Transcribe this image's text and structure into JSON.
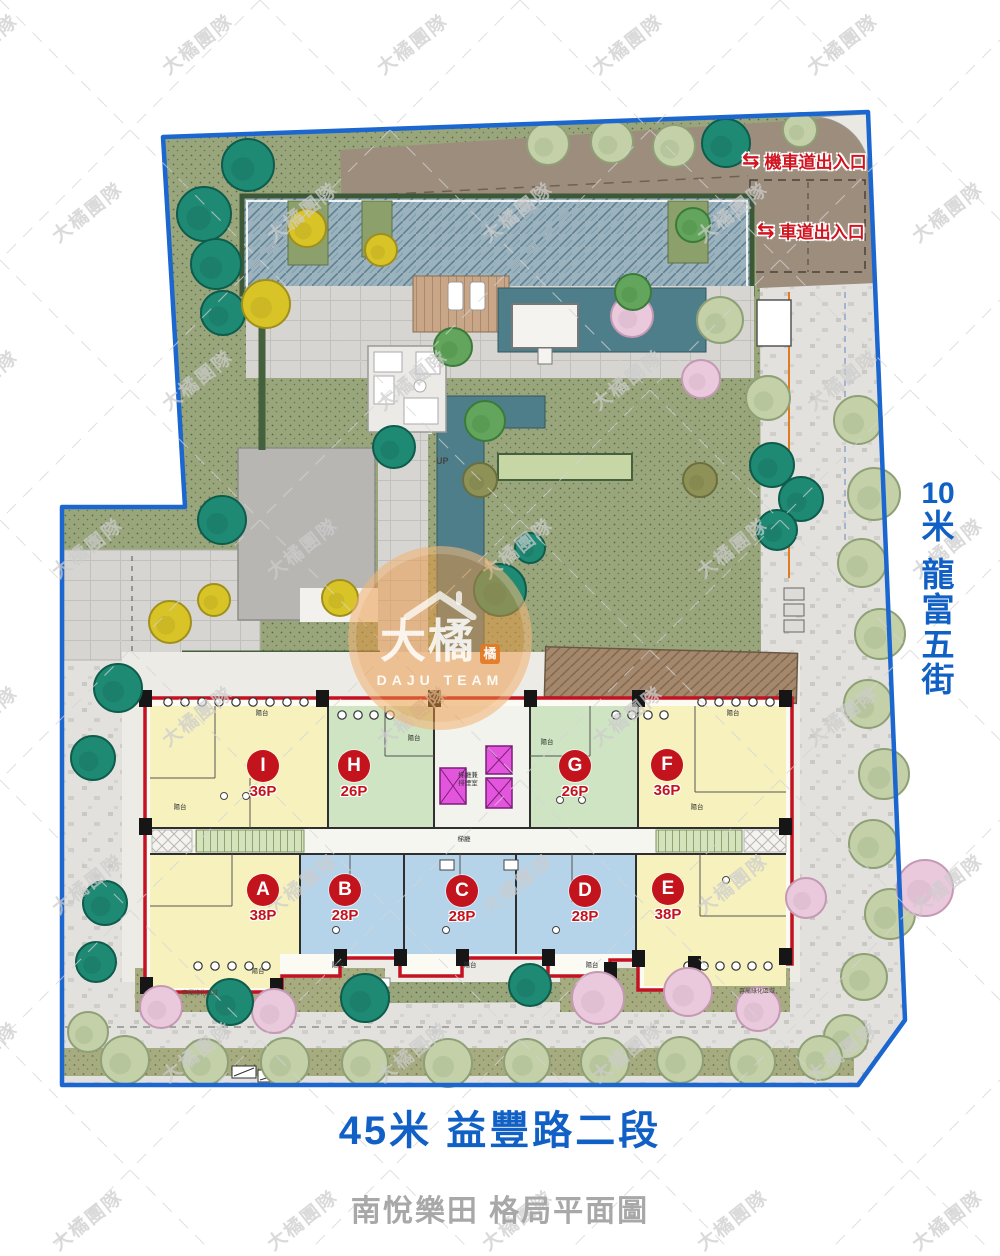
{
  "caption": {
    "project_title": "南悅樂田 格局平面圖"
  },
  "streets": {
    "right": {
      "full": "10米 龍富五街",
      "lines": [
        "10",
        "米",
        "龍",
        "富",
        "五",
        "街"
      ]
    },
    "bottom": {
      "label": "45米 益豐路二段"
    }
  },
  "entrances": {
    "moto": {
      "label": "機車道出入口",
      "icon": "⇆"
    },
    "car": {
      "label": "車道出入口",
      "icon": "⇆"
    }
  },
  "watermark": {
    "team_text": "大橘團隊",
    "logo_main": "大橘",
    "logo_badge": "橘",
    "logo_sub": "DAJU TEAM"
  },
  "building": {
    "units": [
      {
        "id": "I",
        "size": "36P",
        "color": "yellow",
        "cx": 263,
        "cy": 767
      },
      {
        "id": "H",
        "size": "26P",
        "color": "green",
        "cx": 354,
        "cy": 767
      },
      {
        "id": "G",
        "size": "26P",
        "color": "green",
        "cx": 575,
        "cy": 767
      },
      {
        "id": "F",
        "size": "36P",
        "color": "yellow",
        "cx": 667,
        "cy": 766
      },
      {
        "id": "A",
        "size": "38P",
        "color": "yellow",
        "cx": 263,
        "cy": 891
      },
      {
        "id": "B",
        "size": "28P",
        "color": "blue",
        "cx": 345,
        "cy": 891
      },
      {
        "id": "C",
        "size": "28P",
        "color": "blue",
        "cx": 462,
        "cy": 892
      },
      {
        "id": "D",
        "size": "28P",
        "color": "blue",
        "cx": 585,
        "cy": 892
      },
      {
        "id": "E",
        "size": "38P",
        "color": "yellow",
        "cx": 668,
        "cy": 890
      }
    ],
    "labels": {
      "core_line1": "梯廳兼",
      "core_line2": "排煙室",
      "lobby": "梯廳",
      "balcony": "陽台",
      "patio": "專屬綠化區域",
      "up": "UP"
    },
    "balcony_positions": [
      [
        262,
        712
      ],
      [
        180,
        806
      ],
      [
        414,
        737
      ],
      [
        547,
        741
      ],
      [
        733,
        712
      ],
      [
        697,
        806
      ],
      [
        338,
        964
      ],
      [
        470,
        964
      ],
      [
        592,
        964
      ],
      [
        258,
        970
      ]
    ],
    "window_rows": [
      {
        "x": 168,
        "y": 702,
        "n": 9,
        "s": 17
      },
      {
        "x": 342,
        "y": 715,
        "n": 4,
        "s": 16
      },
      {
        "x": 616,
        "y": 715,
        "n": 4,
        "s": 16
      },
      {
        "x": 702,
        "y": 702,
        "n": 5,
        "s": 17
      },
      {
        "x": 198,
        "y": 966,
        "n": 5,
        "s": 17
      },
      {
        "x": 688,
        "y": 966,
        "n": 6,
        "s": 16
      }
    ],
    "pillars": [
      [
        139,
        690
      ],
      [
        316,
        690
      ],
      [
        428,
        690
      ],
      [
        524,
        690
      ],
      [
        632,
        690
      ],
      [
        779,
        690
      ],
      [
        139,
        818
      ],
      [
        779,
        818
      ],
      [
        140,
        977
      ],
      [
        270,
        978
      ],
      [
        334,
        949
      ],
      [
        394,
        949
      ],
      [
        456,
        949
      ],
      [
        542,
        949
      ],
      [
        604,
        962
      ],
      [
        632,
        950
      ],
      [
        688,
        956
      ],
      [
        779,
        948
      ]
    ]
  },
  "colors": {
    "boundary_blue": "#1b66cf",
    "street_text_blue": "#1160c5",
    "entrance_red": "#d01420",
    "unit_label_red": "#c3131c",
    "caption_gray": "#a8a8a8",
    "elevator_magenta": "#e455de",
    "unit_fills": {
      "yellow": "#f6f1bd",
      "green": "#cfe4c3",
      "blue": "#b5d4ea"
    },
    "tree_palette": {
      "teal": {
        "fill": "#1f8a74",
        "stroke": "#0e5c4c"
      },
      "green": {
        "fill": "#63a55c",
        "stroke": "#3c7a3a"
      },
      "sage": {
        "fill": "#c3d0a8",
        "stroke": "#8fa077"
      },
      "yellow": {
        "fill": "#d9c427",
        "stroke": "#a08f1d"
      },
      "pink": {
        "fill": "#eac9dc",
        "stroke": "#c499b4"
      },
      "olive": {
        "fill": "#8f9257",
        "stroke": "#6b6e3d"
      }
    }
  },
  "landscape": {
    "trees": [
      {
        "x": 248,
        "y": 165,
        "r": 26,
        "c": "teal"
      },
      {
        "x": 204,
        "y": 214,
        "r": 27,
        "c": "teal"
      },
      {
        "x": 216,
        "y": 264,
        "r": 25,
        "c": "teal"
      },
      {
        "x": 223,
        "y": 313,
        "r": 22,
        "c": "teal"
      },
      {
        "x": 266,
        "y": 304,
        "r": 24,
        "c": "yellow"
      },
      {
        "x": 222,
        "y": 520,
        "r": 24,
        "c": "teal"
      },
      {
        "x": 118,
        "y": 688,
        "r": 24,
        "c": "teal"
      },
      {
        "x": 93,
        "y": 758,
        "r": 22,
        "c": "teal"
      },
      {
        "x": 105,
        "y": 903,
        "r": 22,
        "c": "teal"
      },
      {
        "x": 96,
        "y": 962,
        "r": 20,
        "c": "teal"
      },
      {
        "x": 307,
        "y": 228,
        "r": 19,
        "c": "yellow"
      },
      {
        "x": 381,
        "y": 250,
        "r": 16,
        "c": "yellow"
      },
      {
        "x": 214,
        "y": 600,
        "r": 16,
        "c": "yellow"
      },
      {
        "x": 170,
        "y": 622,
        "r": 21,
        "c": "yellow"
      },
      {
        "x": 340,
        "y": 598,
        "r": 18,
        "c": "yellow"
      },
      {
        "x": 548,
        "y": 144,
        "r": 21,
        "c": "sage"
      },
      {
        "x": 612,
        "y": 142,
        "r": 21,
        "c": "sage"
      },
      {
        "x": 674,
        "y": 146,
        "r": 21,
        "c": "sage"
      },
      {
        "x": 726,
        "y": 143,
        "r": 24,
        "c": "teal"
      },
      {
        "x": 800,
        "y": 130,
        "r": 17,
        "c": "sage"
      },
      {
        "x": 693,
        "y": 225,
        "r": 17,
        "c": "green"
      },
      {
        "x": 632,
        "y": 316,
        "r": 21,
        "c": "pink"
      },
      {
        "x": 701,
        "y": 379,
        "r": 19,
        "c": "pink"
      },
      {
        "x": 720,
        "y": 320,
        "r": 23,
        "c": "sage"
      },
      {
        "x": 768,
        "y": 398,
        "r": 22,
        "c": "sage"
      },
      {
        "x": 453,
        "y": 347,
        "r": 19,
        "c": "green"
      },
      {
        "x": 485,
        "y": 421,
        "r": 20,
        "c": "green"
      },
      {
        "x": 633,
        "y": 292,
        "r": 18,
        "c": "green"
      },
      {
        "x": 394,
        "y": 447,
        "r": 21,
        "c": "teal"
      },
      {
        "x": 530,
        "y": 548,
        "r": 15,
        "c": "teal"
      },
      {
        "x": 498,
        "y": 583,
        "r": 18,
        "c": "teal"
      },
      {
        "x": 500,
        "y": 590,
        "r": 26,
        "c": "teal"
      },
      {
        "x": 480,
        "y": 480,
        "r": 17,
        "c": "olive"
      },
      {
        "x": 700,
        "y": 480,
        "r": 17,
        "c": "olive"
      },
      {
        "x": 772,
        "y": 465,
        "r": 22,
        "c": "teal"
      },
      {
        "x": 801,
        "y": 499,
        "r": 22,
        "c": "teal"
      },
      {
        "x": 777,
        "y": 530,
        "r": 20,
        "c": "teal"
      },
      {
        "x": 858,
        "y": 420,
        "r": 24,
        "c": "sage"
      },
      {
        "x": 874,
        "y": 494,
        "r": 26,
        "c": "sage"
      },
      {
        "x": 862,
        "y": 563,
        "r": 24,
        "c": "sage"
      },
      {
        "x": 880,
        "y": 634,
        "r": 25,
        "c": "sage"
      },
      {
        "x": 868,
        "y": 704,
        "r": 24,
        "c": "sage"
      },
      {
        "x": 884,
        "y": 774,
        "r": 25,
        "c": "sage"
      },
      {
        "x": 873,
        "y": 844,
        "r": 24,
        "c": "sage"
      },
      {
        "x": 890,
        "y": 914,
        "r": 25,
        "c": "sage"
      },
      {
        "x": 864,
        "y": 977,
        "r": 23,
        "c": "sage"
      },
      {
        "x": 846,
        "y": 1037,
        "r": 22,
        "c": "sage"
      },
      {
        "x": 925,
        "y": 888,
        "r": 28,
        "c": "pink"
      },
      {
        "x": 806,
        "y": 898,
        "r": 20,
        "c": "pink"
      },
      {
        "x": 161,
        "y": 1007,
        "r": 21,
        "c": "pink"
      },
      {
        "x": 274,
        "y": 1011,
        "r": 22,
        "c": "pink"
      },
      {
        "x": 230,
        "y": 1002,
        "r": 23,
        "c": "teal"
      },
      {
        "x": 365,
        "y": 998,
        "r": 24,
        "c": "teal"
      },
      {
        "x": 530,
        "y": 985,
        "r": 21,
        "c": "teal"
      },
      {
        "x": 598,
        "y": 998,
        "r": 26,
        "c": "pink"
      },
      {
        "x": 688,
        "y": 992,
        "r": 24,
        "c": "pink"
      },
      {
        "x": 758,
        "y": 1009,
        "r": 22,
        "c": "pink"
      },
      {
        "x": 88,
        "y": 1032,
        "r": 20,
        "c": "sage"
      },
      {
        "x": 125,
        "y": 1060,
        "r": 24,
        "c": "sage"
      },
      {
        "x": 205,
        "y": 1062,
        "r": 23,
        "c": "sage"
      },
      {
        "x": 285,
        "y": 1062,
        "r": 24,
        "c": "sage"
      },
      {
        "x": 365,
        "y": 1063,
        "r": 23,
        "c": "sage"
      },
      {
        "x": 448,
        "y": 1063,
        "r": 24,
        "c": "sage"
      },
      {
        "x": 527,
        "y": 1062,
        "r": 23,
        "c": "sage"
      },
      {
        "x": 605,
        "y": 1062,
        "r": 24,
        "c": "sage"
      },
      {
        "x": 680,
        "y": 1060,
        "r": 23,
        "c": "sage"
      },
      {
        "x": 752,
        "y": 1062,
        "r": 23,
        "c": "sage"
      },
      {
        "x": 820,
        "y": 1058,
        "r": 22,
        "c": "sage"
      }
    ]
  }
}
